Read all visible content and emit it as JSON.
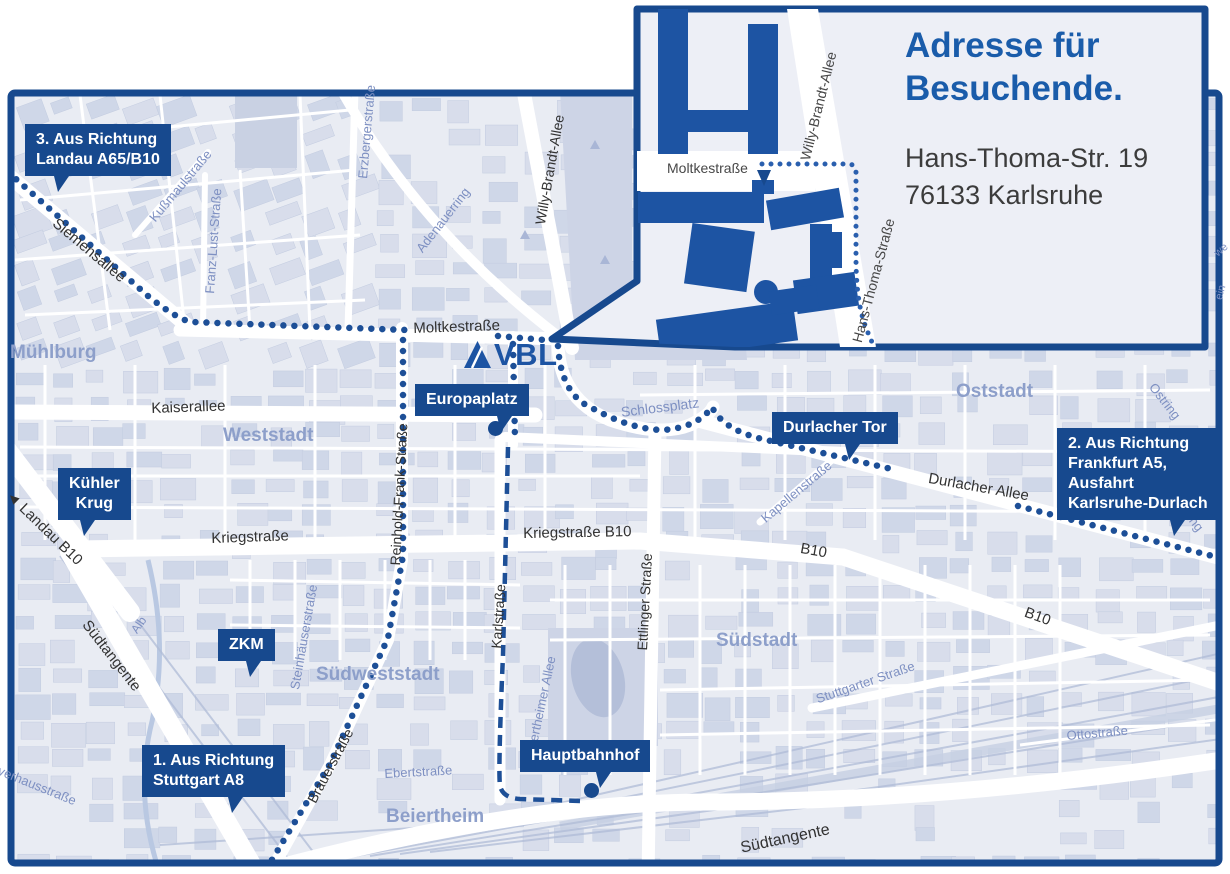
{
  "colors": {
    "navy": "#17498e",
    "brand_blue": "#1d54a3",
    "title_blue": "#1a5caa",
    "route_blue": "#1d4f97",
    "map_bg": "#e9ecf3",
    "block_a": "#d8ddeb",
    "block_b": "#cfd7e8",
    "block_stroke": "#c3cce0",
    "park": "#cdd4e6",
    "water": "#b4bfd9",
    "road_white": "#ffffff",
    "rail": "#b0bcd7",
    "area_label": "#8d9fca",
    "street_blue": "#7e90c2",
    "street_dark": "#323232",
    "inset_bg": "#edeff6"
  },
  "logo": {
    "text": "VBL"
  },
  "inset": {
    "title_line1": "Adresse für",
    "title_line2": "Besuchende.",
    "address_line1": "Hans-Thoma-Str. 19",
    "address_line2": "76133 Karlsruhe",
    "streets": [
      {
        "text": "Moltkestraße",
        "x": 667,
        "y": 160,
        "rot": 0,
        "s": 14
      },
      {
        "text": "Willy-Brandt-Allee",
        "x": 797,
        "y": 158,
        "rot": -76,
        "s": 14
      },
      {
        "text": "Hans-Thoma-Straße",
        "x": 849,
        "y": 340,
        "rot": -75,
        "s": 14
      }
    ]
  },
  "callouts": [
    {
      "name": "route-3-landau",
      "lines": [
        "3. Aus Richtung",
        "Landau A65/B10"
      ],
      "x": 25,
      "y": 124,
      "tail": 20
    },
    {
      "name": "kuehler-krug",
      "lines": [
        "Kühler",
        "Krug"
      ],
      "x": 58,
      "y": 468,
      "tail": 30,
      "center": true
    },
    {
      "name": "zkm",
      "lines": [
        "ZKM"
      ],
      "x": 218,
      "y": 629,
      "tail": 50,
      "center": true
    },
    {
      "name": "route-1-stuttgart",
      "lines": [
        "1. Aus Richtung",
        "Stuttgart A8"
      ],
      "x": 142,
      "y": 745,
      "tail": 60
    },
    {
      "name": "europaplatz",
      "lines": [
        "Europaplatz"
      ],
      "x": 415,
      "y": 384,
      "tail": 72,
      "dot": [
        495,
        428
      ]
    },
    {
      "name": "durlacher-tor",
      "lines": [
        "Durlacher Tor"
      ],
      "x": 772,
      "y": 412,
      "tail": 58
    },
    {
      "name": "route-2-frankfurt",
      "lines": [
        "2. Aus Richtung",
        "Frankfurt A5,",
        "Ausfahrt",
        "Karlsruhe-Durlach"
      ],
      "x": 1057,
      "y": 428,
      "tail": 70
    },
    {
      "name": "hauptbahnhof",
      "lines": [
        "Hauptbahnhof"
      ],
      "x": 520,
      "y": 740,
      "tail": 58,
      "dot": [
        591,
        790
      ]
    }
  ],
  "area_labels": [
    {
      "text": "Mühlburg",
      "x": 10,
      "y": 342
    },
    {
      "text": "Weststadt",
      "x": 223,
      "y": 425
    },
    {
      "text": "Oststadt",
      "x": 956,
      "y": 381
    },
    {
      "text": "Südweststadt",
      "x": 316,
      "y": 664
    },
    {
      "text": "Südstadt",
      "x": 716,
      "y": 630
    },
    {
      "text": "Beiertheim",
      "x": 386,
      "y": 806
    }
  ],
  "street_labels": [
    {
      "text": "Siemensallee",
      "x": 60,
      "y": 215,
      "rot": 40,
      "c": "d",
      "s": 15
    },
    {
      "text": "Kußmaulstraße",
      "x": 146,
      "y": 215,
      "rot": -50,
      "c": "b",
      "s": 13
    },
    {
      "text": "Franz-Lust-Straße",
      "x": 202,
      "y": 293,
      "rot": -86,
      "c": "b",
      "s": 13
    },
    {
      "text": "Erzbergerstraße",
      "x": 355,
      "y": 178,
      "rot": -85,
      "c": "b",
      "s": 13
    },
    {
      "text": "Adenauerring",
      "x": 413,
      "y": 246,
      "rot": -52,
      "c": "b",
      "s": 13
    },
    {
      "text": "Willy-Brandt-Allee",
      "x": 532,
      "y": 223,
      "rot": -80,
      "c": "d",
      "s": 14
    },
    {
      "text": "Moltkestraße",
      "x": 413,
      "y": 320,
      "rot": -2,
      "c": "d",
      "s": 15
    },
    {
      "text": "Kaiserallee",
      "x": 151,
      "y": 400,
      "rot": -2,
      "c": "d",
      "s": 15
    },
    {
      "text": "Schlossplatz",
      "x": 620,
      "y": 404,
      "rot": -7,
      "c": "b",
      "s": 14
    },
    {
      "text": "Reinhold-Frank-Straße",
      "x": 387,
      "y": 565,
      "rot": -87,
      "c": "d",
      "s": 14
    },
    {
      "text": "Kriegstraße",
      "x": 211,
      "y": 530,
      "rot": -2,
      "c": "d",
      "s": 15
    },
    {
      "text": "Kriegstraße B10",
      "x": 523,
      "y": 525,
      "rot": -1,
      "c": "d",
      "s": 15
    },
    {
      "text": "Karlstraße",
      "x": 488,
      "y": 648,
      "rot": -86,
      "c": "d",
      "s": 14
    },
    {
      "text": "Ettlinger Straße",
      "x": 634,
      "y": 650,
      "rot": -87,
      "c": "d",
      "s": 14
    },
    {
      "text": "Kapellenstraße",
      "x": 758,
      "y": 514,
      "rot": -40,
      "c": "b",
      "s": 13
    },
    {
      "text": "Durlacher Allee",
      "x": 930,
      "y": 470,
      "rot": 10,
      "c": "d",
      "s": 15
    },
    {
      "text": "B10",
      "x": 802,
      "y": 540,
      "rot": 10,
      "c": "d",
      "s": 15
    },
    {
      "text": "B10",
      "x": 1028,
      "y": 604,
      "rot": 20,
      "c": "d",
      "s": 15
    },
    {
      "text": "Ostring",
      "x": 1158,
      "y": 380,
      "rot": 52,
      "c": "b",
      "s": 13
    },
    {
      "text": "Ostring",
      "x": 1181,
      "y": 492,
      "rot": 52,
      "c": "b",
      "s": 13
    },
    {
      "text": "Stuttgarter Straße",
      "x": 814,
      "y": 692,
      "rot": -19,
      "c": "b",
      "s": 13
    },
    {
      "text": "Südtangente",
      "x": 92,
      "y": 617,
      "rot": 52,
      "c": "d",
      "s": 15
    },
    {
      "text": "Südtangente",
      "x": 739,
      "y": 840,
      "rot": -12,
      "c": "d",
      "s": 16
    },
    {
      "text": "◄ Landau B10",
      "x": 14,
      "y": 487,
      "rot": 44,
      "c": "d",
      "s": 15
    },
    {
      "text": "Brauerstraße",
      "x": 304,
      "y": 798,
      "rot": -62,
      "c": "d",
      "s": 14
    },
    {
      "text": "Ebertstraße",
      "x": 384,
      "y": 766,
      "rot": -3,
      "c": "b",
      "s": 13
    },
    {
      "text": "Steinhäuserstraße",
      "x": 287,
      "y": 688,
      "rot": -80,
      "c": "b",
      "s": 13
    },
    {
      "text": "Beiertheimer Allee",
      "x": 522,
      "y": 758,
      "rot": -78,
      "c": "b",
      "s": 13
    },
    {
      "text": "Alb",
      "x": 128,
      "y": 628,
      "rot": -55,
      "c": "b",
      "s": 12
    },
    {
      "text": "Pulverhausstraße",
      "x": -16,
      "y": 756,
      "rot": 22,
      "c": "b",
      "s": 13
    },
    {
      "text": "Ottostraße",
      "x": 1066,
      "y": 728,
      "rot": -5,
      "c": "b",
      "s": 13
    },
    {
      "text": "we",
      "x": 1212,
      "y": 250,
      "rot": -40,
      "c": "b",
      "s": 11
    },
    {
      "text": "ein",
      "x": 1213,
      "y": 298,
      "rot": -75,
      "c": "b",
      "s": 11
    }
  ],
  "routes": [
    {
      "d": "M8,172 L60,218 L148,296 Q178,320 192,322 L406,330",
      "style": "dots"
    },
    {
      "d": "M498,336 L545,340",
      "style": "dots"
    },
    {
      "d": "M513,344 L515,440",
      "style": "dots"
    },
    {
      "d": "M558,346 Q561,395 592,408 Q630,429 662,430 Q697,428 712,407 Q722,428 758,438 L896,470",
      "style": "dots"
    },
    {
      "d": "M1018,506 L1228,560",
      "style": "dots"
    },
    {
      "d": "M403,340 L403,556 L388,638 L330,764 L267,868",
      "style": "dots"
    },
    {
      "d": "M508,447 L503,655 Q498,770 500,786 Q503,798 520,799 L580,801",
      "style": "dash"
    }
  ],
  "inset_route": {
    "d": "M762,164 L848,164 Q856,164 856,173 L856,258 Q856,300 865,325 Q872,344 877,351",
    "style": "dots"
  }
}
